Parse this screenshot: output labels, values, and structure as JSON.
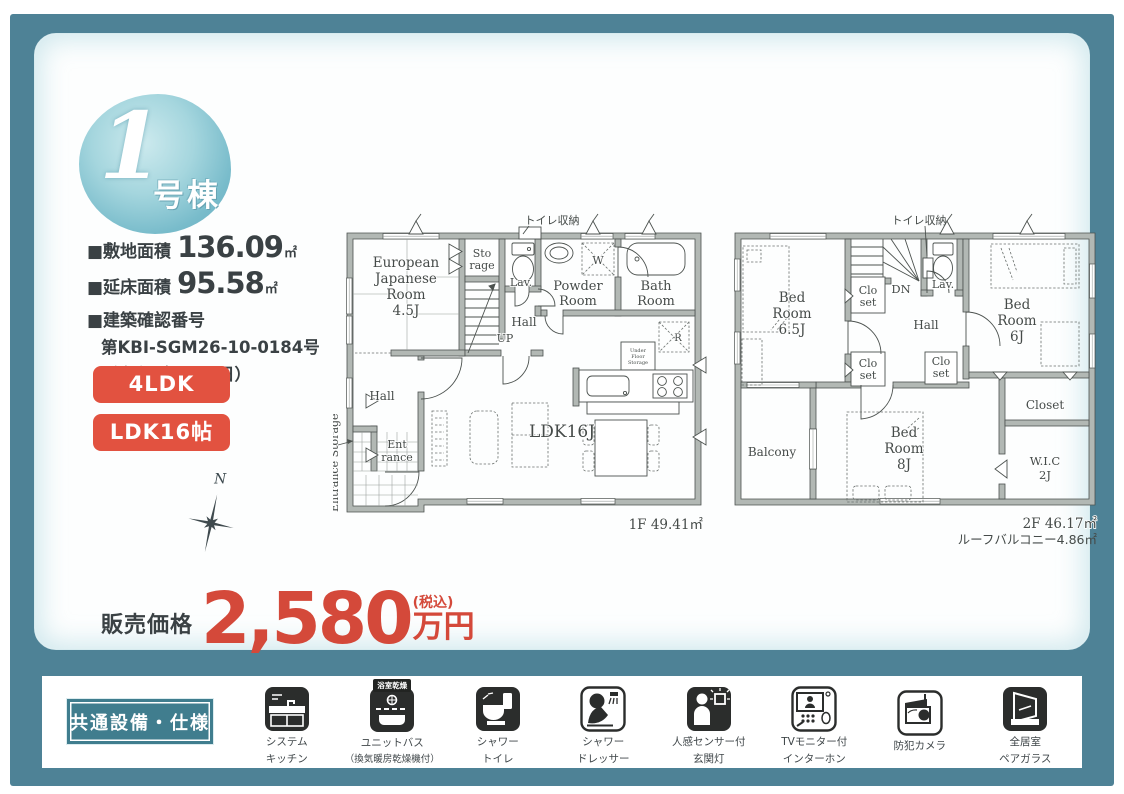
{
  "badge": {
    "number": "1",
    "suffix": "号棟"
  },
  "property": {
    "site_area_label": "■敷地面積",
    "site_area_value": "136.09",
    "site_area_unit": "㎡",
    "floor_area_label": "■延床面積",
    "floor_area_value": "95.58",
    "floor_area_unit": "㎡",
    "confirmation_label": "■建築確認番号",
    "confirmation_number": "第KBI-SGM26-10-0184号",
    "confirmation_date": "（令和8年2月9日）"
  },
  "tags": {
    "layout": "4LDK",
    "ldk_size": "LDK16帖"
  },
  "compass": {
    "north": "N"
  },
  "price": {
    "label": "販売価格",
    "amount": "2,580",
    "tax_note": "(税込)",
    "unit": "万円"
  },
  "floor1": {
    "toilet_storage_note": "トイレ収納",
    "area_label": "1F 49.41㎡",
    "labels": {
      "ejr1": "European",
      "ejr2": "Japanese",
      "ejr3": "Room",
      "ejr4": "4.5J",
      "sto1": "Sto",
      "sto2": "rage",
      "lav": "Lav.",
      "powder1": "Powder",
      "powder2": "Room",
      "bath1": "Bath",
      "bath2": "Room",
      "w": "W",
      "r": "R",
      "hall_up": "Hall",
      "up": "UP",
      "ufs1": "Under",
      "ufs2": "Floor",
      "ufs3": "Storage",
      "hall": "Hall",
      "ent1": "Ent",
      "ent2": "rance",
      "ldk": "LDK16J",
      "entrance_storage": "Entrance Storage"
    }
  },
  "floor2": {
    "toilet_storage_note": "トイレ収納",
    "area_label": "2F 46.17㎡",
    "roof_balcony_label": "ルーフバルコニー4.86㎡",
    "labels": {
      "bed65_1": "Bed",
      "bed65_2": "Room",
      "bed65_3": "6.5J",
      "clo1a": "Clo",
      "clo1b": "set",
      "clo2a": "Clo",
      "clo2b": "set",
      "clo3a": "Clo",
      "clo3b": "set",
      "dn": "DN",
      "lav": "Lav.",
      "hall": "Hall",
      "bed6_1": "Bed",
      "bed6_2": "Room",
      "bed6_3": "6J",
      "balcony": "Balcony",
      "bed8_1": "Bed",
      "bed8_2": "Room",
      "bed8_3": "8J",
      "closet": "Closet",
      "wic1": "W.I.C",
      "wic2": "2J"
    }
  },
  "footer": {
    "title": "共通設備・仕様",
    "features": [
      {
        "icon": "system-kitchen-icon",
        "line1": "システム",
        "line2": "キッチン"
      },
      {
        "icon": "unit-bath-icon",
        "chip": "浴室乾燥",
        "line1": "ユニットバス",
        "line2": "（換気暖房乾燥機付）"
      },
      {
        "icon": "shower-toilet-icon",
        "line1": "シャワー",
        "line2": "トイレ"
      },
      {
        "icon": "shower-dresser-icon",
        "line1": "シャワー",
        "line2": "ドレッサー"
      },
      {
        "icon": "sensor-light-icon",
        "line1": "人感センサー付",
        "line2": "玄関灯"
      },
      {
        "icon": "tv-intercom-icon",
        "line1": "TVモニター付",
        "line2": "インターホン"
      },
      {
        "icon": "security-camera-icon",
        "line1": "防犯カメラ",
        "line2": ""
      },
      {
        "icon": "pair-glass-icon",
        "line1": "全居室",
        "line2": "ペアガラス"
      }
    ]
  },
  "colors": {
    "frame_teal": "#4e8296",
    "badge_teal": "#79bccb",
    "tag_red": "#e25240",
    "price_red": "#d4493a",
    "footer_box_teal": "#407d8e",
    "wall_gray": "#b2b8b4"
  }
}
